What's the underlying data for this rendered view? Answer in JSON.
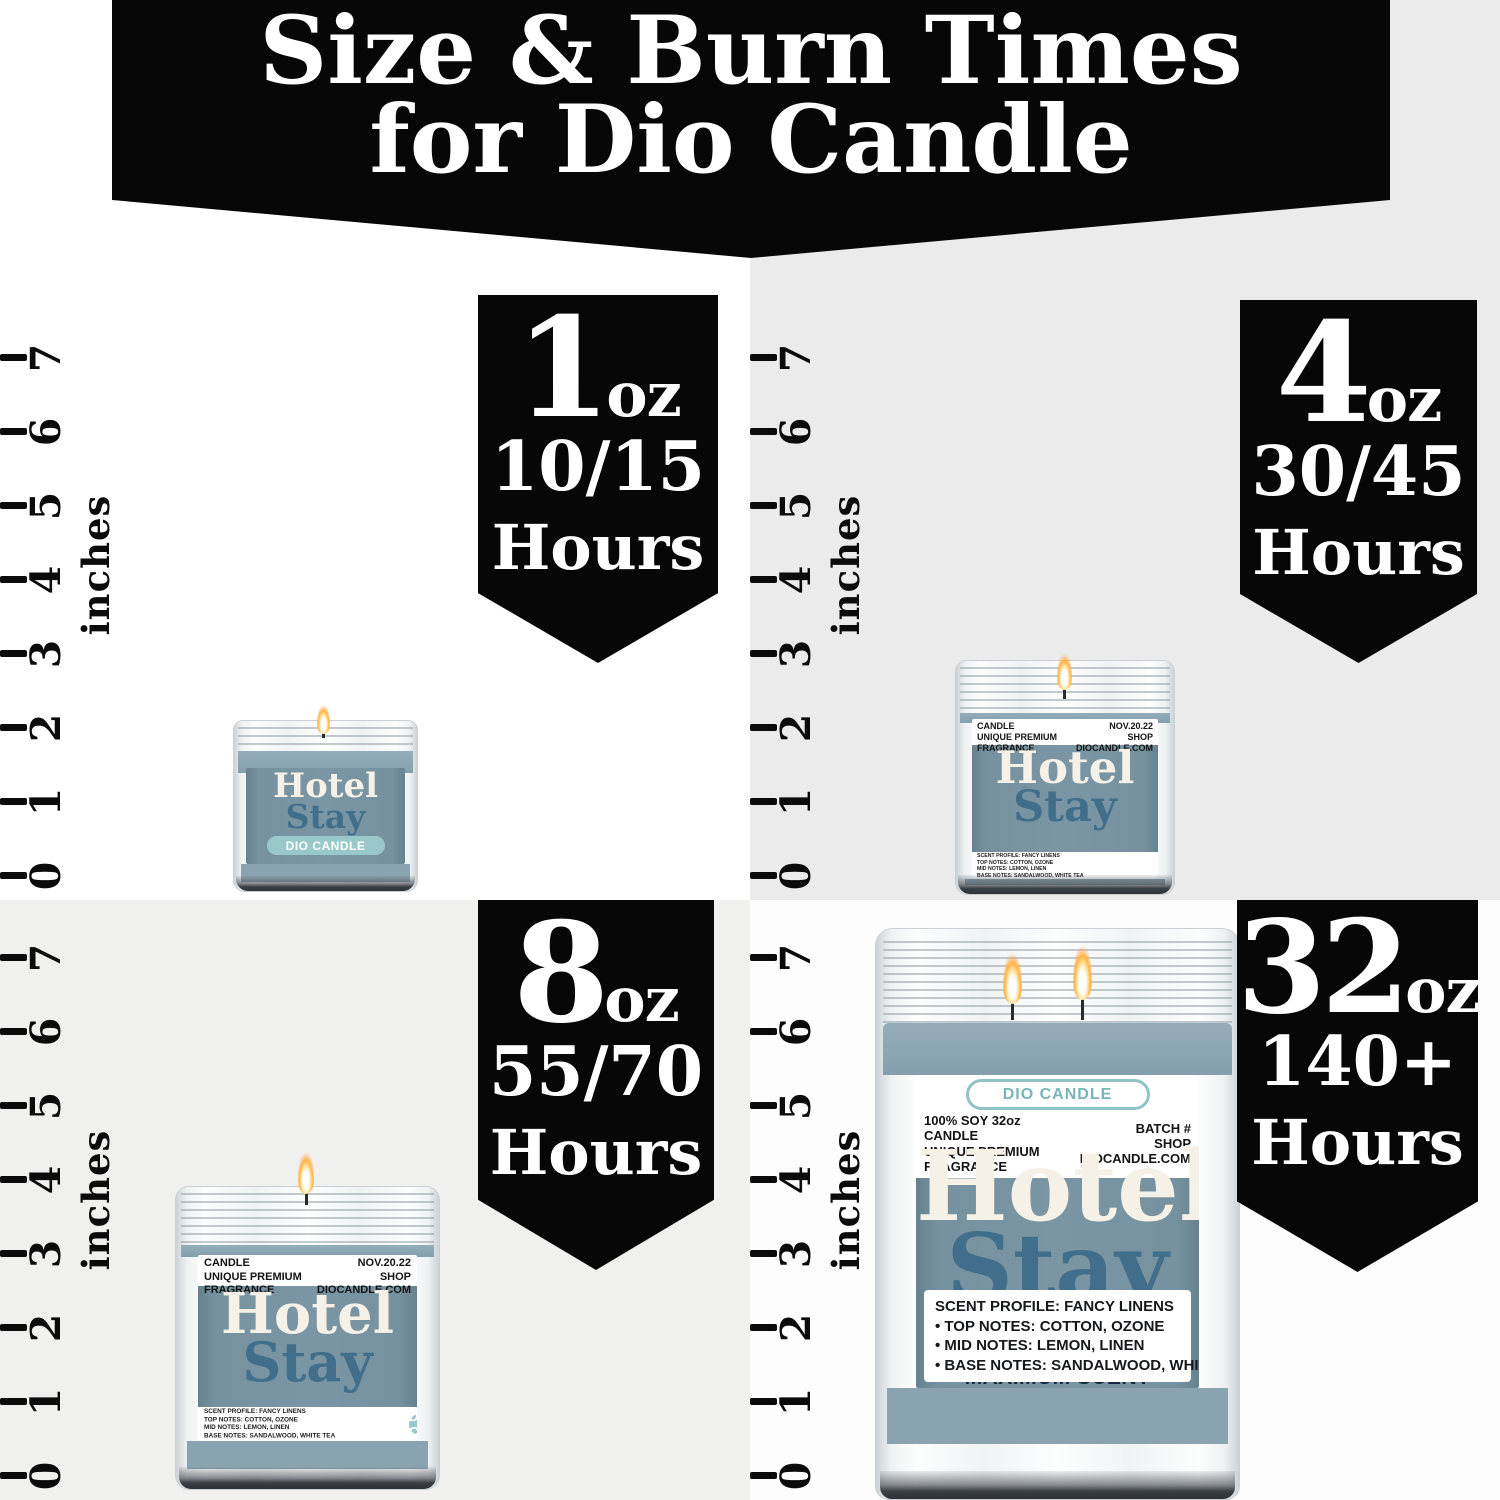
{
  "banner": {
    "line1": "Size & Burn Times",
    "line2": "for Dio Candle"
  },
  "ruler": {
    "unit": "inches",
    "ticks": [
      "0",
      "1",
      "2",
      "3",
      "4",
      "5",
      "6",
      "7"
    ]
  },
  "badges": [
    {
      "size": "1",
      "unit": "oz",
      "burn": "10/15",
      "hours": "Hours"
    },
    {
      "size": "4",
      "unit": "oz",
      "burn": "30/45",
      "hours": "Hours"
    },
    {
      "size": "8",
      "unit": "oz",
      "burn": "55/70",
      "hours": "Hours"
    },
    {
      "size": "32",
      "unit": "oz",
      "burn": "140+",
      "hours": "Hours"
    }
  ],
  "candles": {
    "oz1": {
      "name1": "Hotel",
      "name2": "Stay",
      "brand": "DIO CANDLE"
    },
    "oz4": {
      "info_left": [
        "100% SOY 4oz CANDLE",
        "UNIQUE PREMIUM FRAGRANCE"
      ],
      "info_right": [
        "BATCH # NOV.20.22",
        "SHOP DIOCANDLE.COM"
      ],
      "name1": "Hotel",
      "name2": "Stay",
      "brand": "DIO CANDLE",
      "notes": [
        "SCENT PROFILE: FANCY LINENS",
        "TOP NOTES: COTTON, OZONE",
        "MID NOTES: LEMON, LINEN",
        "BASE NOTES: SANDALWOOD, WHITE TEA"
      ]
    },
    "oz8": {
      "info_left": [
        "100% SOY 8oz CANDLE",
        "UNIQUE PREMIUM FRAGRANCE"
      ],
      "info_right": [
        "BATCH # NOV.20.22",
        "SHOP DIOCANDLE.COM"
      ],
      "name1": "Hotel",
      "name2": "Stay",
      "brand": "DIO CANDLE",
      "notes": [
        "SCENT PROFILE: FANCY LINENS",
        "TOP NOTES: COTTON, OZONE",
        "MID NOTES: LEMON, LINEN",
        "BASE NOTES: SANDALWOOD, WHITE TEA"
      ]
    },
    "oz32": {
      "brand": "DIO CANDLE",
      "info_left": [
        "100% SOY 32oz CANDLE",
        "UNIQUE PREMIUM FRAGRANCE"
      ],
      "info_right": [
        "BATCH #",
        "SHOP DIOCANDLE.COM"
      ],
      "name1": "Hotel",
      "name2": "Stay",
      "features": [
        "DOUBLE WICK",
        "MAXIMUM SCENT IMPACT"
      ],
      "notes": [
        "SCENT PROFILE: FANCY LINENS",
        "• TOP NOTES: COTTON, OZONE",
        "• MID NOTES: LEMON, LINEN",
        "• BASE NOTES: SANDALWOOD, WHITE TEA"
      ]
    }
  },
  "colors": {
    "banner_bg": "#070707",
    "quadrant_gray": "#EBEBEB",
    "label_blue": "#7A95A4",
    "wax_blue": "#8CA5B2",
    "name_cream": "#F5F1E6",
    "name_steel": "#416F8B",
    "pill_mint": "#98C8CA",
    "feature_navy": "#16273B"
  }
}
